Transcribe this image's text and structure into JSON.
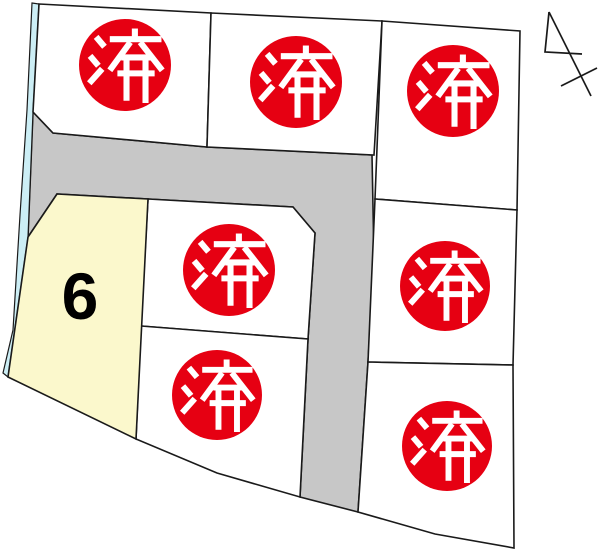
{
  "map": {
    "kind": "subdivision-lot-map",
    "orientation_mark": "north-arrow"
  },
  "labels": {
    "sold": "済",
    "available_lot_number": "6"
  },
  "lots": [
    {
      "id": "top-left",
      "status": "sold",
      "badge": "済"
    },
    {
      "id": "top-middle",
      "status": "sold",
      "badge": "済"
    },
    {
      "id": "top-right",
      "status": "sold",
      "badge": "済"
    },
    {
      "id": "middle",
      "status": "sold",
      "badge": "済"
    },
    {
      "id": "middle-right",
      "status": "sold",
      "badge": "済"
    },
    {
      "id": "lot-6",
      "status": "available",
      "number": "6"
    },
    {
      "id": "bottom-middle",
      "status": "sold",
      "badge": "済"
    },
    {
      "id": "bottom-right",
      "status": "sold",
      "badge": "済"
    }
  ],
  "counts": {
    "sold": 7,
    "available": 1
  },
  "colors": {
    "sold_badge_red": "#e60012",
    "road_gray": "#c7c7c7",
    "available_lot_yellow": "#fbf8cc",
    "waterway_cyan": "#cceef5",
    "boundary_line": "#1a1a1a"
  }
}
